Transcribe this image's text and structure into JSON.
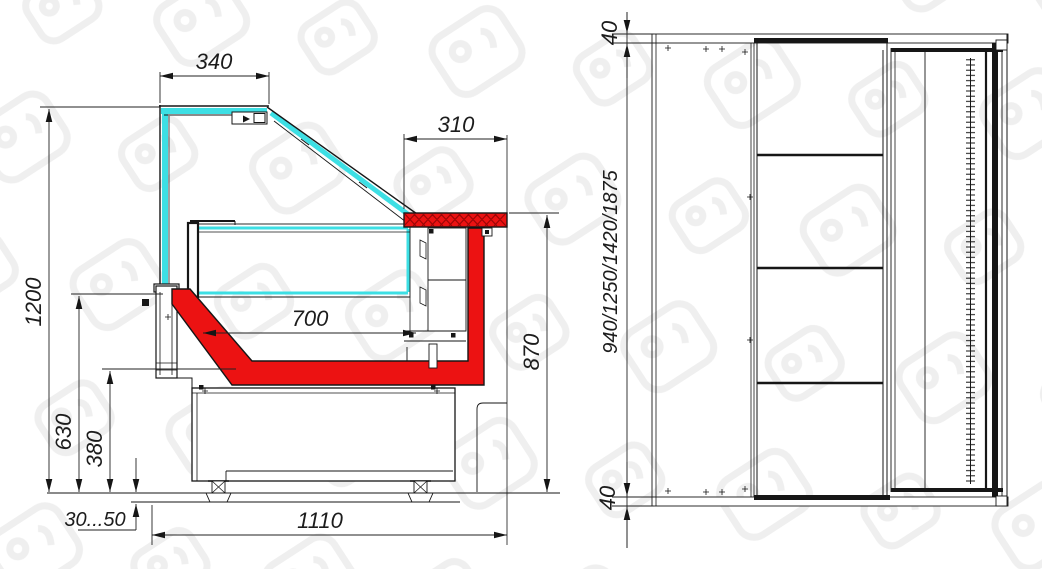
{
  "drawing": {
    "side_view": {
      "dim_top_glass": "340",
      "dim_canopy": "310",
      "dim_overall_height": "1200",
      "dim_deck_height": "630",
      "dim_bumper_height": "380",
      "dim_display_depth": "700",
      "dim_counter_height": "870",
      "dim_foot_adjust": "30...50",
      "dim_overall_depth": "1110"
    },
    "front_view": {
      "dim_top_overhang": "40",
      "dim_length_options": "940/1250/1420/1875",
      "dim_bottom_overhang": "40"
    },
    "colors": {
      "glass_cyan": "#3ddfe4",
      "accent_red": "#ec1212",
      "hatch_red": "#9c0606",
      "line_black": "#161616",
      "watermark_gray": "#ececec"
    }
  }
}
